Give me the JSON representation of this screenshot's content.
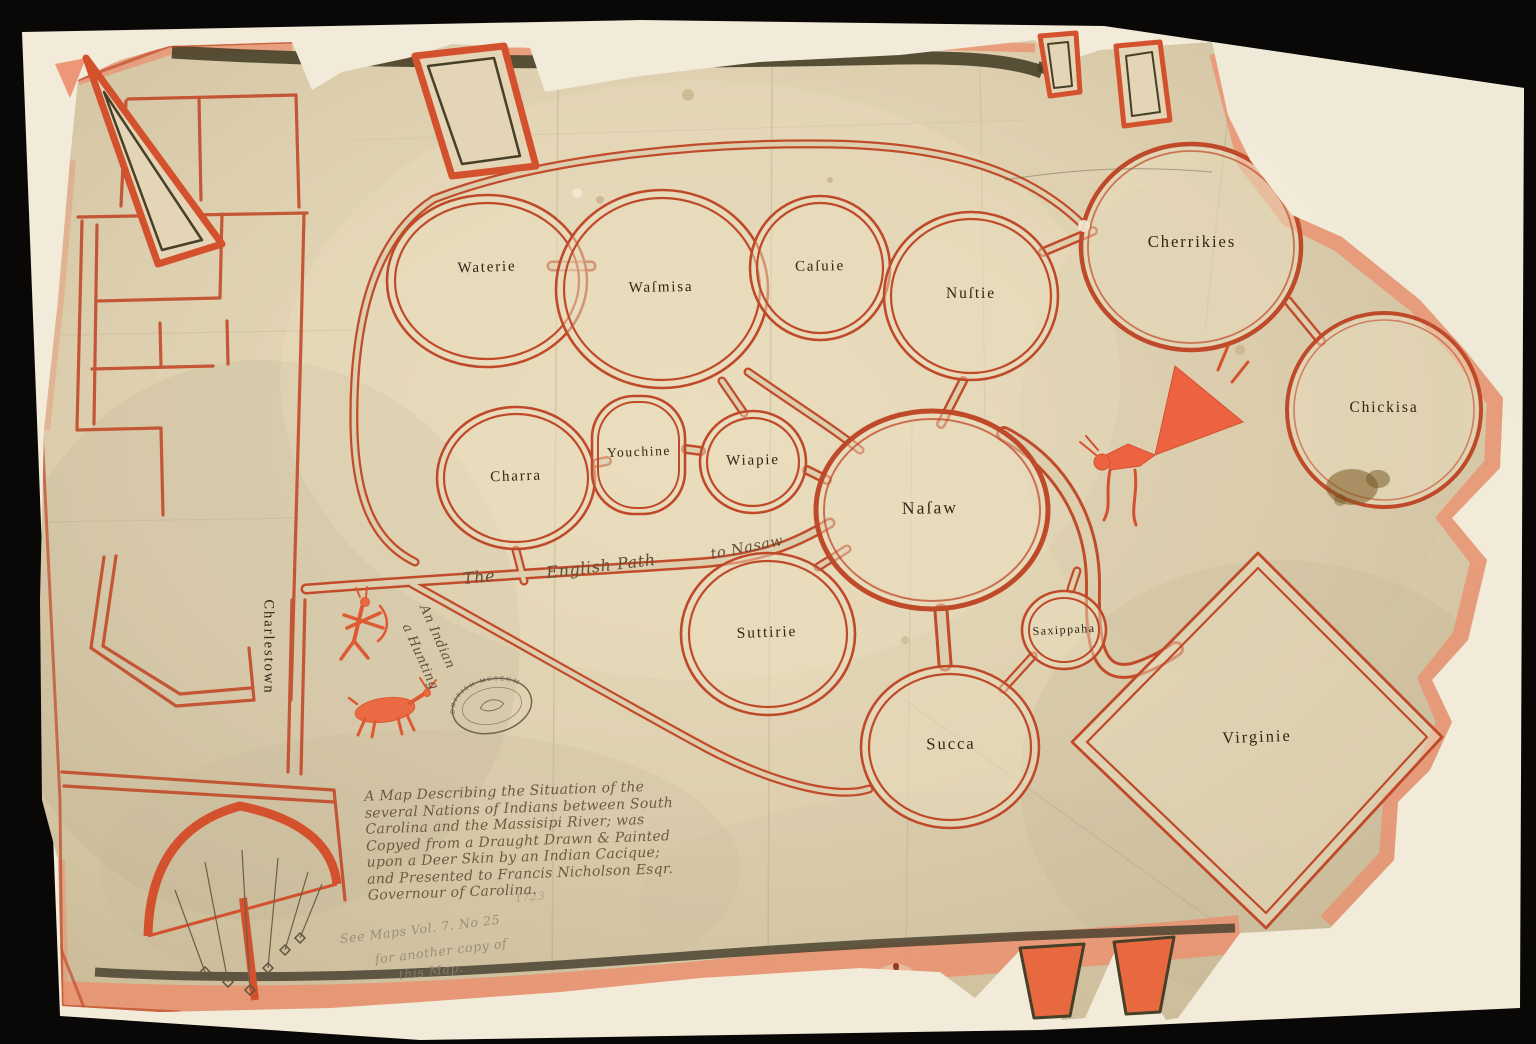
{
  "map": {
    "nations": [
      {
        "name": "Waterie"
      },
      {
        "name": "Waſmisa"
      },
      {
        "name": "Caſuie"
      },
      {
        "name": "Nuſtie"
      },
      {
        "name": "Cherrikies"
      },
      {
        "name": "Chickisa"
      },
      {
        "name": "Charra"
      },
      {
        "name": "Youchine"
      },
      {
        "name": "Wiapie"
      },
      {
        "name": "Naſaw"
      },
      {
        "name": "Saxippaha"
      },
      {
        "name": "Suttirie"
      },
      {
        "name": "Succa"
      },
      {
        "name": "Virginie"
      }
    ],
    "places": {
      "charlestown": "Charlestown"
    },
    "path_label": {
      "the": "The",
      "english_path": "English Path",
      "to_nasaw": "to Nasaw"
    },
    "figures": {
      "hunter_caption_line1": "An Indian",
      "hunter_caption_line2": "a Hunting"
    },
    "title_block": {
      "lines": [
        "A Map Describing the Situation of the",
        "several Nations of Indians between South",
        "Carolina and the Massisipi River; was",
        "Copyed from a Draught Drawn & Painted",
        "upon a Deer Skin by an Indian Cacique;",
        "and Presented to Francis Nicholson Esqr.",
        "Governour of Carolina."
      ]
    },
    "annotations": {
      "year": "1723",
      "archive_note_line1": "See Maps Vol. 7. No 25",
      "archive_note_line2": "for another copy of",
      "archive_note_line3": "this Map.",
      "stamp": "BRITISH MUSEUM"
    },
    "colors": {
      "ink_red": "#c24d2c",
      "wash_salmon": "#ec8e6d",
      "band_dark": "#4a4231",
      "skin": "#ddcfae",
      "mount": "#f2ebd9",
      "label_ink": "#2f2616",
      "script_ink": "#6d5a41",
      "pencil": "#8d8373"
    }
  }
}
